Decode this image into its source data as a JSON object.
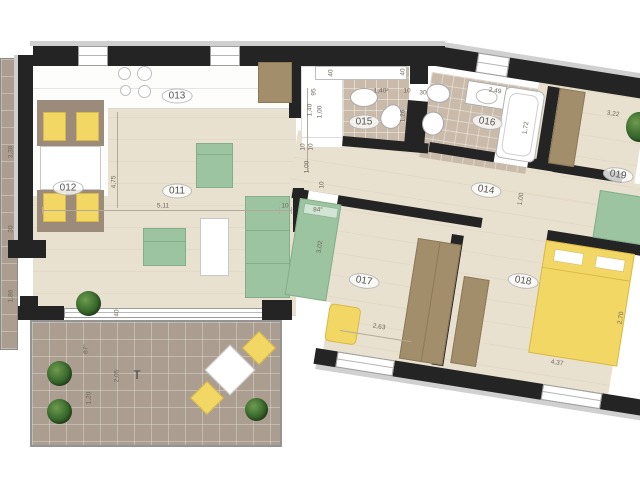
{
  "labels": {
    "r011": "011",
    "r012": "012",
    "r013": "013",
    "r014": "014",
    "r015": "015",
    "r016": "016",
    "r017": "017",
    "r018": "018",
    "r019": "019",
    "terrace": "T"
  },
  "dims": {
    "bal_len": "3,38",
    "bal_w": "30",
    "bal_d": "1,86",
    "liv_h": "4,75",
    "liv_w": "5,11",
    "liv_t": "10",
    "liv_door": "40",
    "ter_ang": "87°",
    "ter_w": "2,05",
    "ter_d": "1,20",
    "n15_t1": "40",
    "n15_t2": "40",
    "n15_95": "95",
    "n15_140": "1,40",
    "n15_100": "1,00",
    "n15_10a": "10",
    "n15_10b": "10",
    "n15_100b": "1,00",
    "b15_area": "1,40²",
    "b15_10": "10",
    "b15_30": "30",
    "b15_126": "1,26",
    "b16_249": "2,49",
    "b16_172": "1,72",
    "h_10": "10",
    "h_84": "84°",
    "h_100": "1,00",
    "r17_302": "3,02",
    "r17_263": "2,63",
    "r18_270": "2,70",
    "r18_437": "4,37",
    "r19_322": "3,22"
  },
  "colors": {
    "wall": "#242424",
    "wood_floor": "#e9e1cf",
    "bath_tile": "#c9baaa",
    "terrace_tile": "#ab9e90",
    "sofa_green": "#9cc4a1",
    "accent_yellow": "#f3d765",
    "wardrobe_brown": "#a38e6c",
    "dim_text": "#6f675c"
  }
}
